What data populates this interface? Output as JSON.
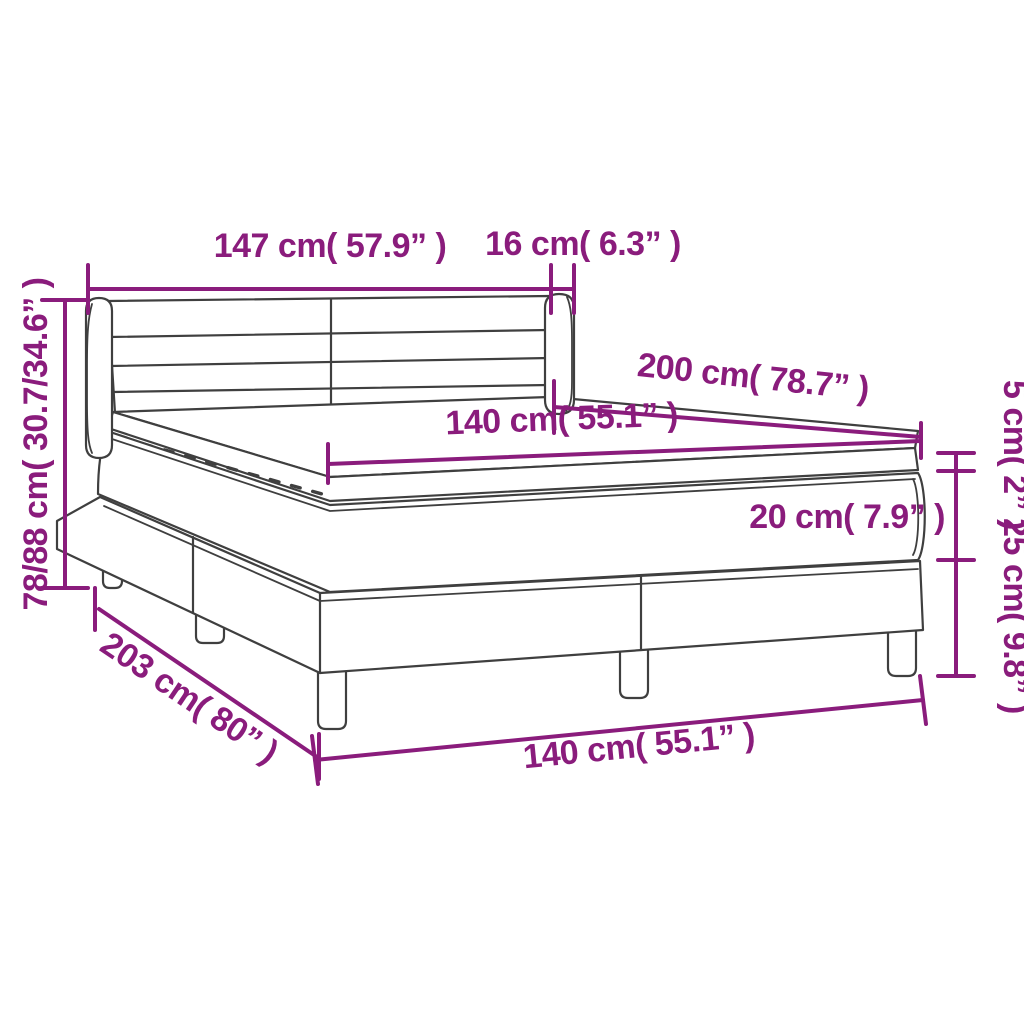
{
  "diagram": {
    "title": "box-spring-bed-dimension-diagram",
    "accent_color": "#8a1c7c",
    "line_color": "#3f3f3f",
    "background_color": "#ffffff"
  },
  "dimensions": {
    "headboard_width": "147 cm( 57.9” )",
    "headboard_wing_depth": "16 cm( 6.3” )",
    "total_height": "78/88 cm( 30.7/34.6” )",
    "bed_length": "200 cm( 78.7” )",
    "mattress_width": "140 cm( 55.1” )",
    "topper_height": "5 cm( 2” )",
    "mattress_height": "20 cm( 7.9” )",
    "base_height": "25 cm( 9.8” )",
    "base_length": "203 cm( 80” )",
    "base_width": "140 cm( 55.1” )"
  }
}
